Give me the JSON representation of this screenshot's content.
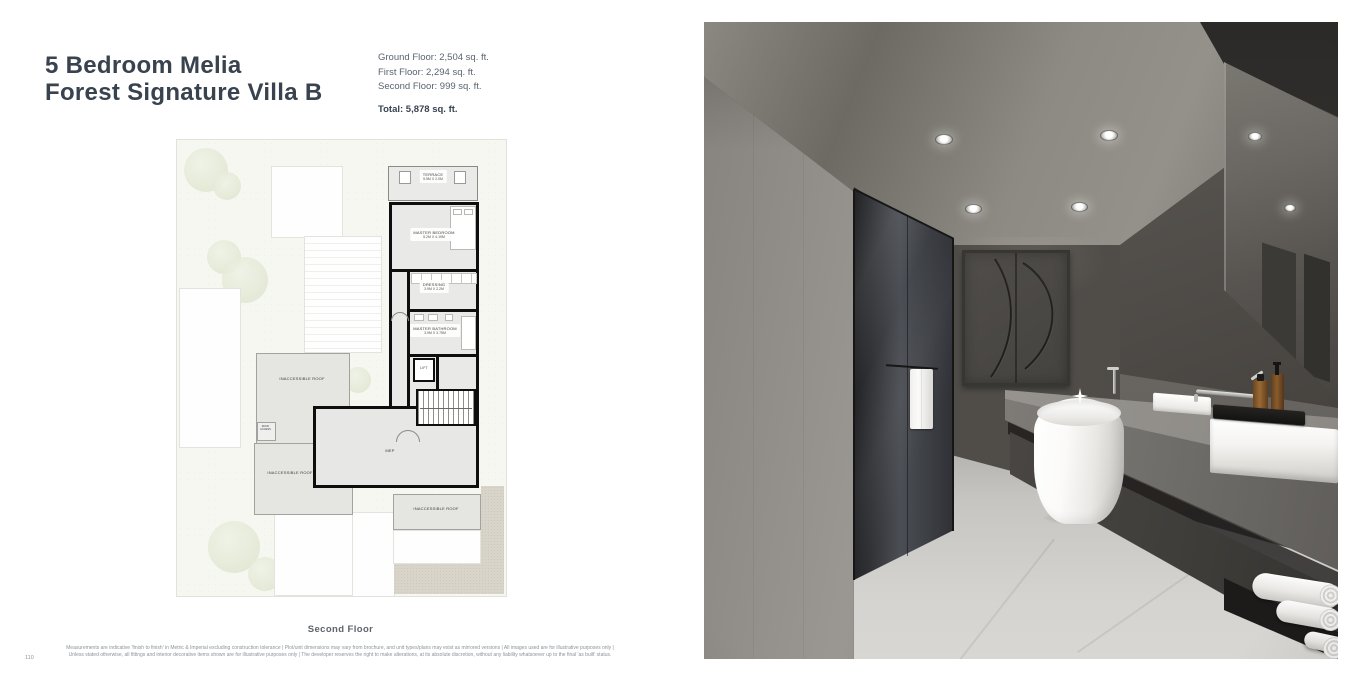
{
  "page_number": "110",
  "title": {
    "line1": "5 Bedroom Melia",
    "line2": "Forest Signature Villa B"
  },
  "areas": {
    "ground_floor": "Ground Floor: 2,504 sq. ft.",
    "first_floor": "First Floor: 2,294 sq. ft.",
    "second_floor": "Second Floor: 999 sq. ft.",
    "total": "Total: 5,878 sq. ft."
  },
  "floorplan": {
    "caption": "Second Floor",
    "rooms": [
      {
        "name": "TERRACE",
        "dims": "5.5M X 2.0M"
      },
      {
        "name": "MASTER BEDROOM",
        "dims": "5.2M X 4.19M"
      },
      {
        "name": "DRESSING",
        "dims": "3.9M X 2.2M"
      },
      {
        "name": "MASTER BATHROOM",
        "dims": "3.9M X 3.75M"
      },
      {
        "name": "LIFT",
        "dims": ""
      },
      {
        "name": "MEP",
        "dims": ""
      },
      {
        "name": "ROOF ACCESS",
        "dims": ""
      },
      {
        "name": "INACCESSIBLE ROOF",
        "dims": ""
      },
      {
        "name": "INACCESSIBLE ROOF",
        "dims": ""
      },
      {
        "name": "INACCESSIBLE ROOF",
        "dims": ""
      }
    ]
  },
  "disclaimer": {
    "line1": "Measurements are indicative 'finish to finish' in Metric & Imperial excluding construction tolerance | Plot/unit dimensions may vary from brochure, and unit types/plans may exist as mirrored versions | All images used are for illustrative purposes only |",
    "line2": "Unless stated otherwise, all fittings and interior decorative items shown are for illustrative purposes only | The developer reserves the right to make alterations, at its absolute discretion, without any liability whatsoever up to the final 'as built' status."
  },
  "colors": {
    "title": "#39424f",
    "plan_walls": "#0e0e0e",
    "plan_sand": "#d9d4c9",
    "photo_back_wall": "#4a4743"
  }
}
